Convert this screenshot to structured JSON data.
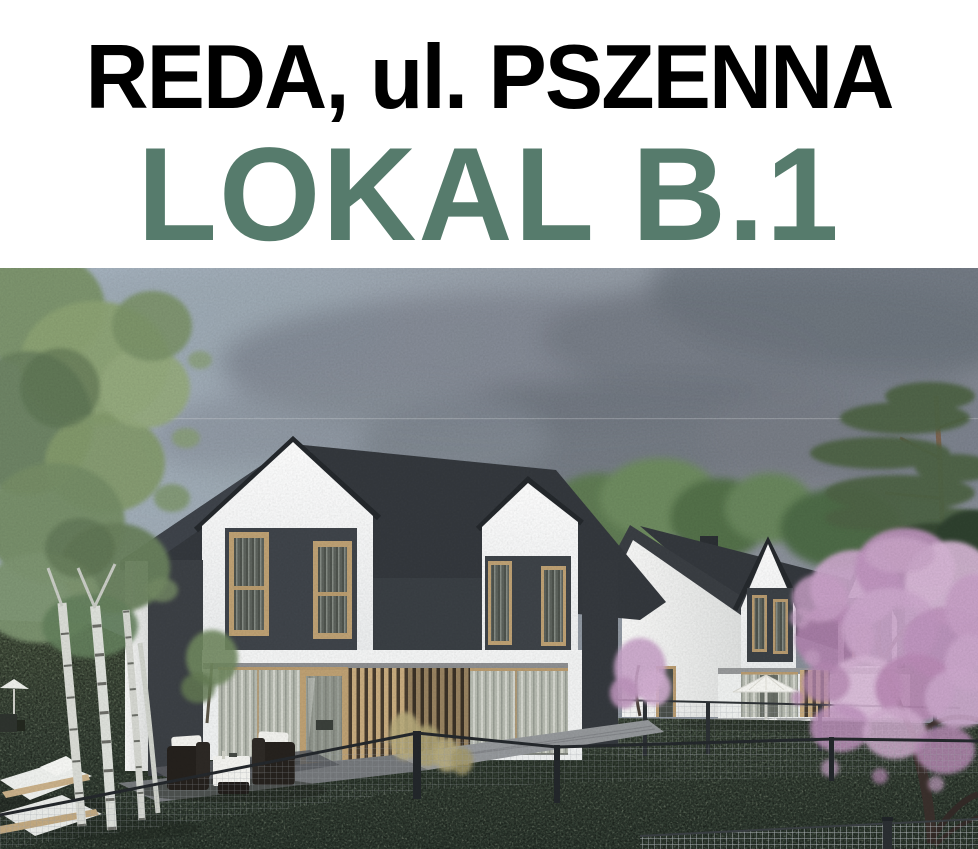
{
  "header": {
    "title": "REDA, ul. PSZENNA",
    "subtitle": "LOKAL B.1",
    "title_color": "#000000",
    "subtitle_color": "#567b6c",
    "background": "#ffffff"
  },
  "scene": {
    "description": "Architectural rendering of two modern duplex houses with dark gable roofs, white facades and anthracite panels, garden lawn, birch trees, blossoming magnolia tree, pine tree, cloudy grey sky, garden lounge furniture, sun loungers, parasols and wire-mesh fences",
    "palette": {
      "sky": "#98a1ab",
      "cloud_dark": "#6d737c",
      "roof": "#34383d",
      "wall_white": "#f4f5f5",
      "wall_dark": "#3e4247",
      "window_frame_wood": "#bda073",
      "lawn": "#41503d",
      "birch_foliage": "#83996d",
      "birch_trunk": "#dadcd6",
      "magnolia_pink": "#c29ec2",
      "pine_green": "#4d6244",
      "paving": "#8f9294",
      "fence": "#2f3337"
    }
  }
}
